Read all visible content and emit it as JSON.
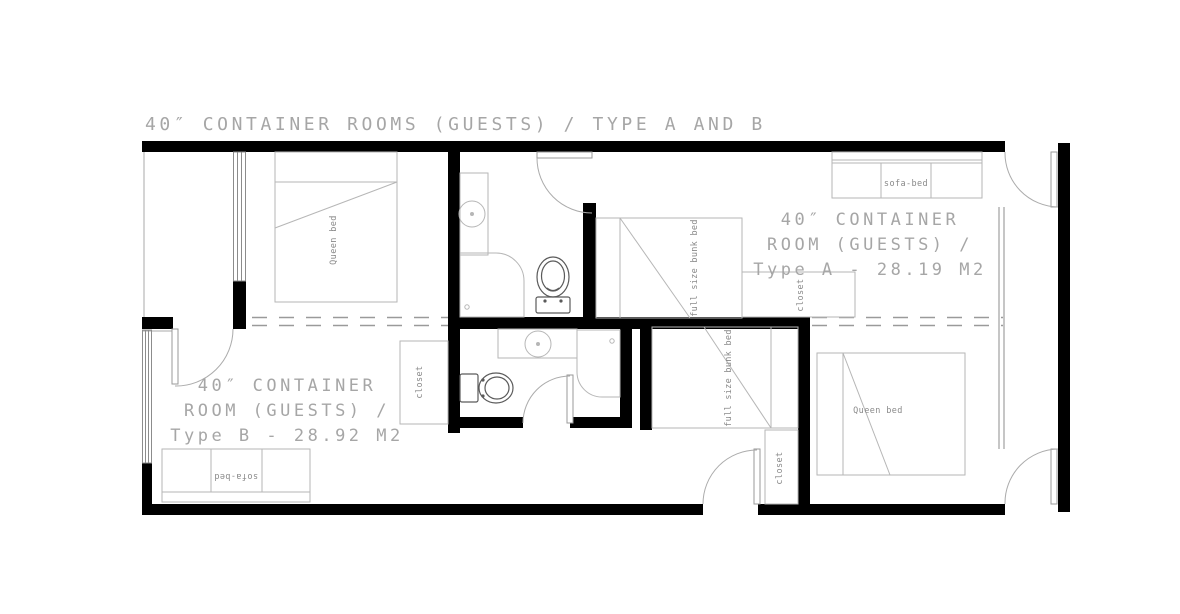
{
  "title": "40″ CONTAINER ROOMS (GUESTS) / TYPE A AND B",
  "rooms": {
    "type_a": {
      "lines": [
        "40″ CONTAINER",
        "ROOM (GUESTS) /",
        "Type A - 28.19 M2"
      ],
      "area_m2": "28.19"
    },
    "type_b": {
      "lines": [
        "40″ CONTAINER",
        "ROOM (GUESTS) /",
        "Type B - 28.92 M2"
      ],
      "area_m2": "28.92"
    }
  },
  "furniture": {
    "queen_bed_top": "Queen bed",
    "queen_bed_bottom": "Queen bed",
    "sofa_bed_top": "sofa-bed",
    "sofa_bed_bottom": "sofa-bed",
    "bunk_bed_top": "full size bunk bed",
    "bunk_bed_bottom": "full size bunk bed",
    "closet_top_right": "closet",
    "closet_lower_left": "closet",
    "closet_bottom_middle": "closet"
  },
  "colors": {
    "wall": "#000000",
    "furniture_line": "#b6b6b6",
    "fixture_line": "#5a5a5a",
    "label_text": "#a6a6a6",
    "furniture_text": "#8a8a8a",
    "dashed_junction": "#9a9a9a",
    "background": "#ffffff"
  }
}
